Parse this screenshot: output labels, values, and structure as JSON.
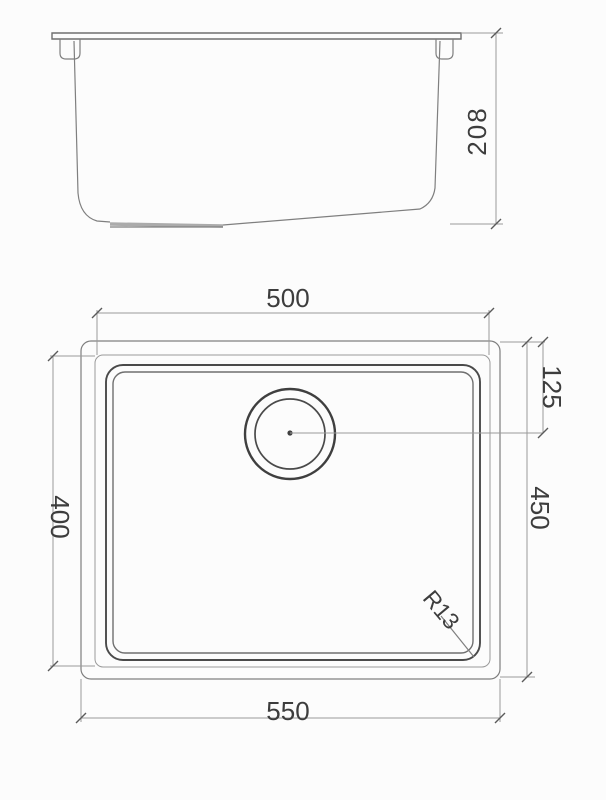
{
  "drawing": {
    "side": {
      "height_label": "208"
    },
    "plan": {
      "top_width_label": "500",
      "bottom_width_label": "550",
      "left_depth_label": "400",
      "right_depth_label": "450",
      "drain_offset_label": "125",
      "corner_radius_label": "R13"
    },
    "colors": {
      "background": "#fcfcfc",
      "line_light": "#9a9a9a",
      "line_medium": "#7f7f7f",
      "line_dark": "#4a4a4a",
      "text": "#3d3d3d"
    }
  }
}
